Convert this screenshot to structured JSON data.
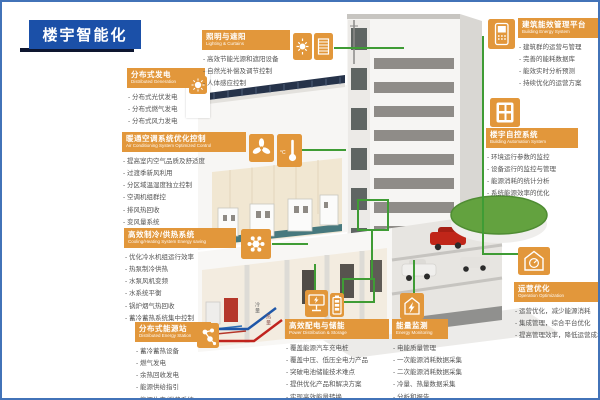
{
  "page": {
    "title": "楼宇智能化",
    "colors": {
      "accent_orange": "#E2973B",
      "title_blue": "#1B50A8",
      "connector_green": "#3F9C35",
      "frame_blue": "#4273B8",
      "pipe_cold_blue": "#1F57A8",
      "pipe_hot_red": "#C0231D"
    }
  },
  "pipes": {
    "cold_label": "冷量",
    "hot_label": "热量"
  },
  "sections": {
    "distributed_generation": {
      "title": "分布式发电",
      "subtitle": "Distributed Generation",
      "icons": [
        "pv-sun-icon"
      ],
      "items": [
        "分布式光伏发电",
        "分布式燃气发电",
        "分布式风力发电"
      ]
    },
    "lighting": {
      "title": "照明与遮阳",
      "subtitle": "Lighting & Curtains",
      "icons": [
        "sun-icon",
        "blinds-icon"
      ],
      "items": [
        "高效节能光源和遮阳设备",
        "自然光补偿及调节控制",
        "人体感应控制"
      ]
    },
    "hvac": {
      "title": "暖通空调系统优化控制",
      "subtitle": "Air Conditioning System Optimized Control",
      "icons": [
        "fan-icon",
        "thermometer-icon"
      ],
      "items": [
        "提高室内空气品质及舒适度",
        "过渡季新风利用",
        "分区域温湿度独立控制",
        "空调机组群控",
        "排风热回收",
        "变风量系统"
      ]
    },
    "cooling_heating": {
      "title": "高效制冷/供热系统",
      "subtitle": "Cooling/Heating System Energy saving",
      "icons": [
        "gear-icon"
      ],
      "items": [
        "优化冷水机组运行效率",
        "热泵制冷供热",
        "水泵风机变频",
        "水系统平衡",
        "锅炉烟气热回收",
        "蓄冷蓄热系统集中控制"
      ]
    },
    "energy_station": {
      "title": "分布式能源站",
      "subtitle": "Distributed Energy Station",
      "icons": [
        "molecule-icon"
      ],
      "items": [
        "蓄冷蓄热设备",
        "燃气发电",
        "余热回收发电",
        "能源供给指引",
        "能源生产/消费系统"
      ]
    },
    "power_storage": {
      "title": "高效配电与储能",
      "subtitle": "Power Distribution & Storage",
      "icons": [
        "ev-charger-icon",
        "battery-icon"
      ],
      "items": [
        "覆盖能源汽车充电桩",
        "覆盖中压、低压全电力产品",
        "突破电池储能技术难点",
        "提供优化产品和解决方案",
        "实现高效能量转换"
      ]
    },
    "energy_monitoring": {
      "title": "能量监测",
      "subtitle": "Energy Monitoring",
      "icons": [
        "building-bolt-icon"
      ],
      "items": [
        "电能质量管理",
        "一次能源消耗数据采集",
        "二次能源消耗数据采集",
        "冷量、热量数据采集",
        "分析和报告"
      ]
    },
    "energy_platform": {
      "title": "建筑能效管理平台",
      "subtitle": "Building Energy System",
      "icons": [
        "tablet-icon"
      ],
      "items": [
        "建筑群的运营与管理",
        "完善的能耗数据库",
        "能效实时分析预测",
        "持续优化的运营方案"
      ]
    },
    "building_automation": {
      "title": "楼宇自控系统",
      "subtitle": "Building Automation System",
      "icons": [
        "window-panel-icon"
      ],
      "items": [
        "环境运行参数的监控",
        "设备运行的监控与管理",
        "能源消耗的统计分析",
        "系统能源效率的优化"
      ]
    },
    "operation_optimization": {
      "title": "运营优化",
      "subtitle": "Operation Optimization",
      "icons": [
        "house-gauge-icon"
      ],
      "items": [
        "运营优化，减少能源消耗",
        "集成管理，综合平台优化",
        "提高管理效率，降低运营成本"
      ]
    }
  }
}
